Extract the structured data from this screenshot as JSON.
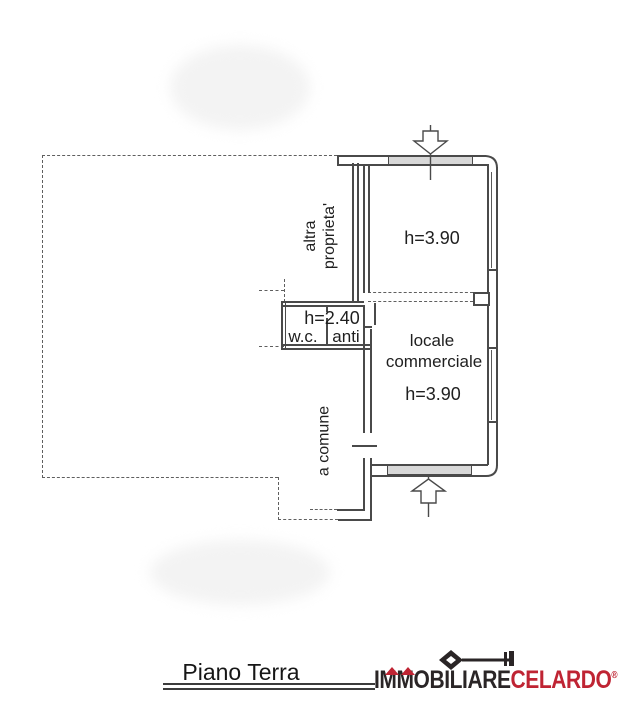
{
  "canvas": {
    "width": 626,
    "height": 720
  },
  "colors": {
    "wall_line": "#4a4a4a",
    "dashed_line": "#5f5f5f",
    "window_band_fill": "#d8d8d8",
    "text": "#1f1f1f",
    "logo_black": "#2a2526",
    "logo_red": "#bf2433"
  },
  "plan": {
    "labels": {
      "altra_proprieta_line1": "altra",
      "altra_proprieta_line2": "proprieta'",
      "top_room_height": "h=3.90",
      "service_height": "h=2.40",
      "wc": "w.c.",
      "anti": "anti",
      "commercial_line1": "locale",
      "commercial_line2": "commerciale",
      "commercial_height": "h=3.90",
      "corridor": "a comune"
    },
    "icons": {
      "entrance_top": "entrance-arrow-down-icon",
      "entrance_bottom": "entrance-arrow-up-icon"
    }
  },
  "footer": {
    "title": "Piano Terra",
    "logo": {
      "black_part": "IMMOBILIARE",
      "red_part": "CELARDO",
      "reg_mark": "®",
      "icons": [
        "house-roof-icon",
        "house-roof-icon",
        "key-icon"
      ]
    }
  }
}
